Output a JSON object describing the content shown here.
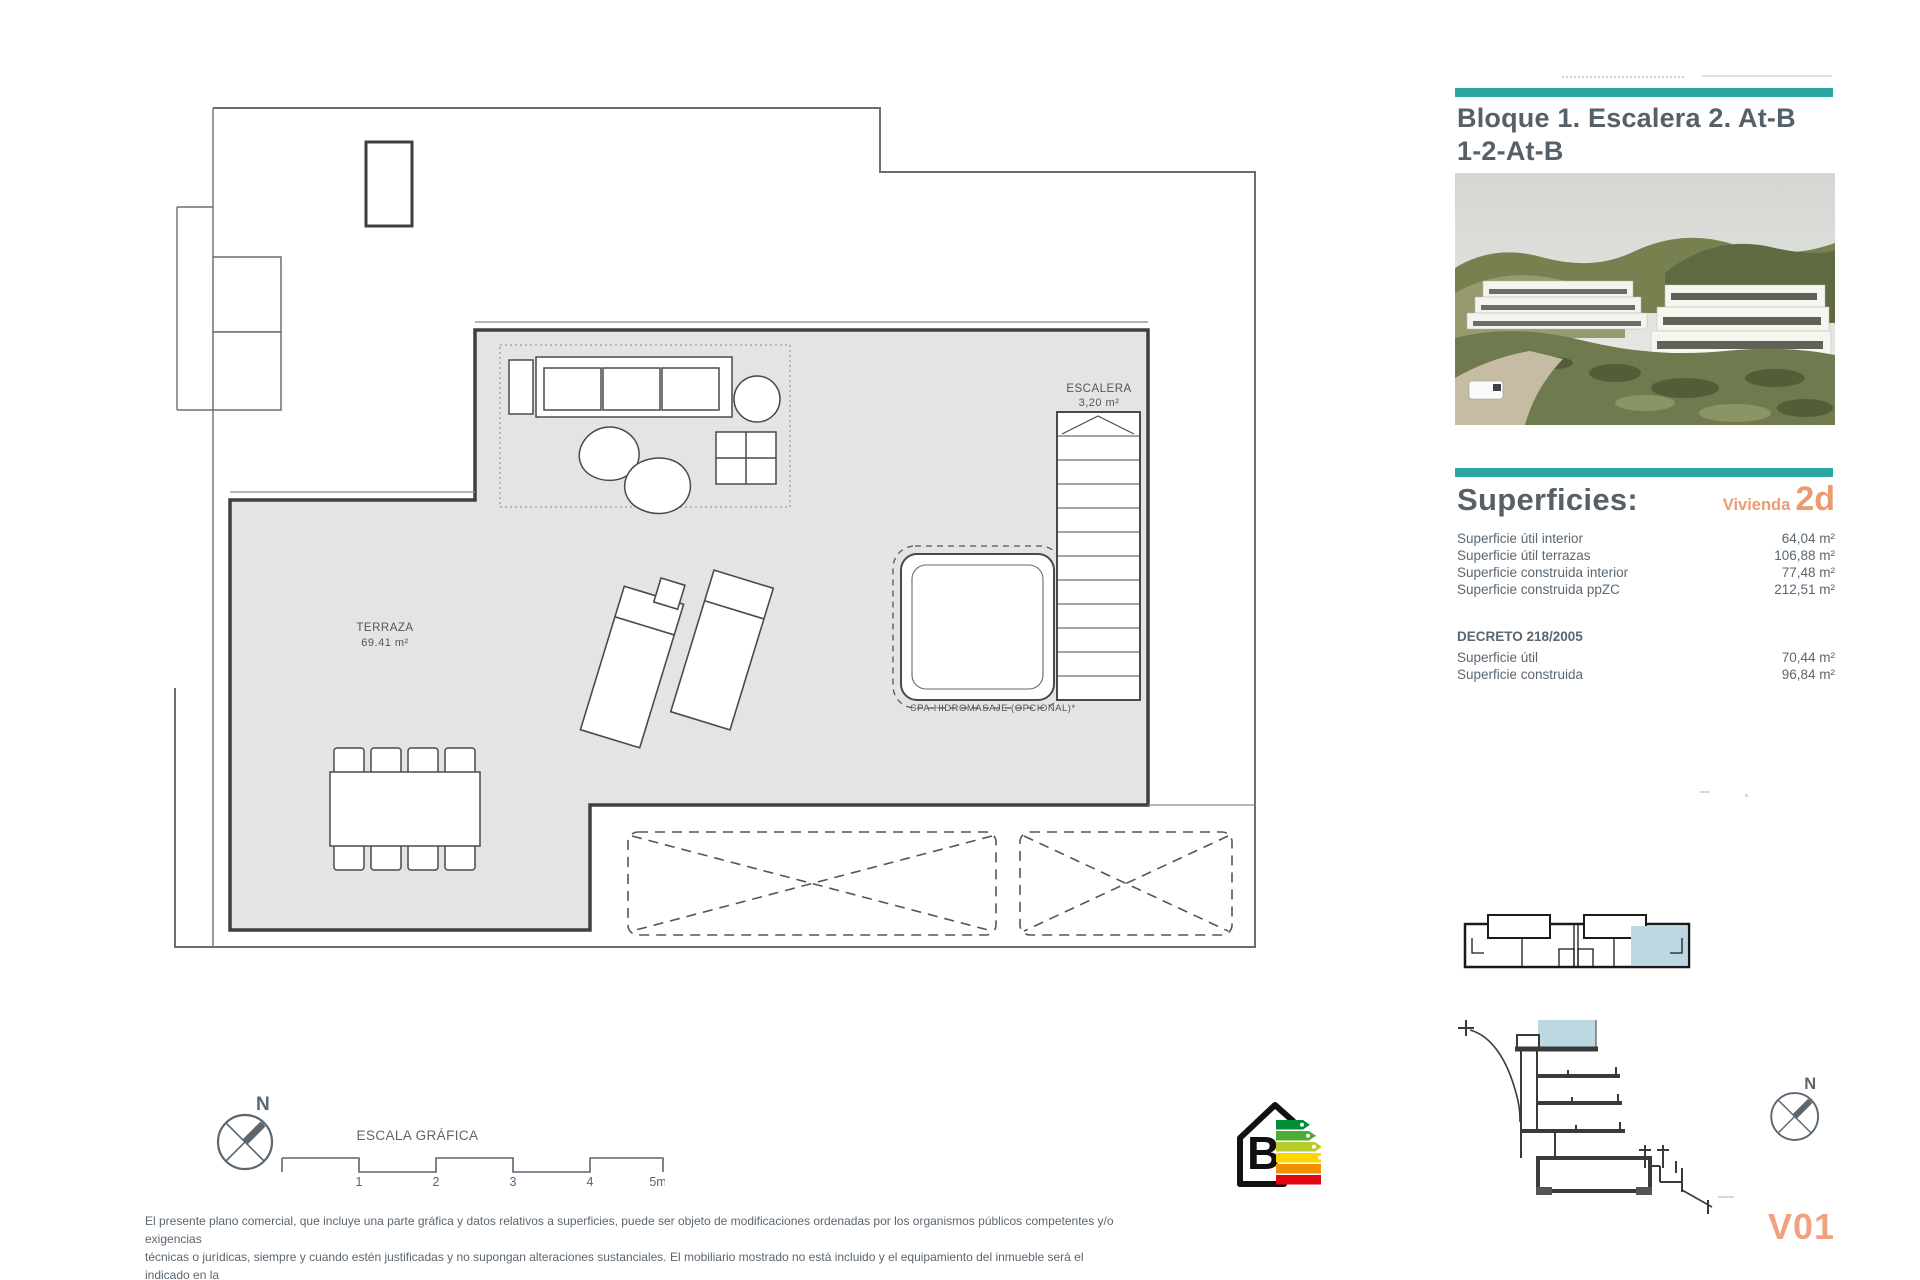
{
  "title_block": {
    "line1": "Bloque 1. Escalera 2. At-B",
    "line2": "1-2-At-B"
  },
  "superficies": {
    "heading": "Superficies:",
    "vivienda_label": "Vivienda",
    "vivienda_code": "2d",
    "rows": [
      {
        "label": "Superficie útil interior",
        "value": "64,04 m²"
      },
      {
        "label": "Superficie útil terrazas",
        "value": "106,88 m²"
      },
      {
        "label": "Superficie construida interior",
        "value": "77,48 m²"
      },
      {
        "label": "Superficie construida ppZC",
        "value": "212,51 m²"
      }
    ],
    "decreto": {
      "heading": "DECRETO 218/2005",
      "rows": [
        {
          "label": "Superficie útil",
          "value": "70,44 m²"
        },
        {
          "label": "Superficie construida",
          "value": "96,84 m²"
        }
      ]
    }
  },
  "plan": {
    "terraza_label": "TERRAZA",
    "terraza_area": "69.41 m²",
    "escalera_label": "ESCALERA",
    "escalera_area": "3,20 m²",
    "spa_label": "SPA-HIDROMASAJE (OPCIONAL)*"
  },
  "scale_bar": {
    "label": "ESCALA GRÁFICA",
    "ticks": [
      "1",
      "2",
      "3",
      "4",
      "5m"
    ]
  },
  "compass": {
    "north_label": "N"
  },
  "energy": {
    "rating": "B"
  },
  "version": "V01",
  "disclaimer": {
    "lines": [
      "El presente plano comercial, que incluye una parte gráfica y datos relativos a superficies, puede ser objeto de modificaciones ordenadas por los organismos públicos competentes y/o exigencias",
      "técnicas o jurídicas, siempre y cuando estén justificadas y no supongan alteraciones sustanciales. El mobiliario mostrado no está incluido y el equipamiento del inmueble será el indicado en la",
      "correspondiente memoria de calidades."
    ]
  },
  "colors": {
    "teal": "#2AA7A2",
    "orange": "#EC9B70",
    "text_gray": "#5A6670",
    "plan_fill": "#E4E5E2",
    "wall": "#3F3F3F",
    "highlight_blue": "#BCD9E2",
    "energy_bars": [
      "#008D36",
      "#4CAC33",
      "#B8CC2E",
      "#FFD500",
      "#F29100",
      "#E30613"
    ]
  }
}
